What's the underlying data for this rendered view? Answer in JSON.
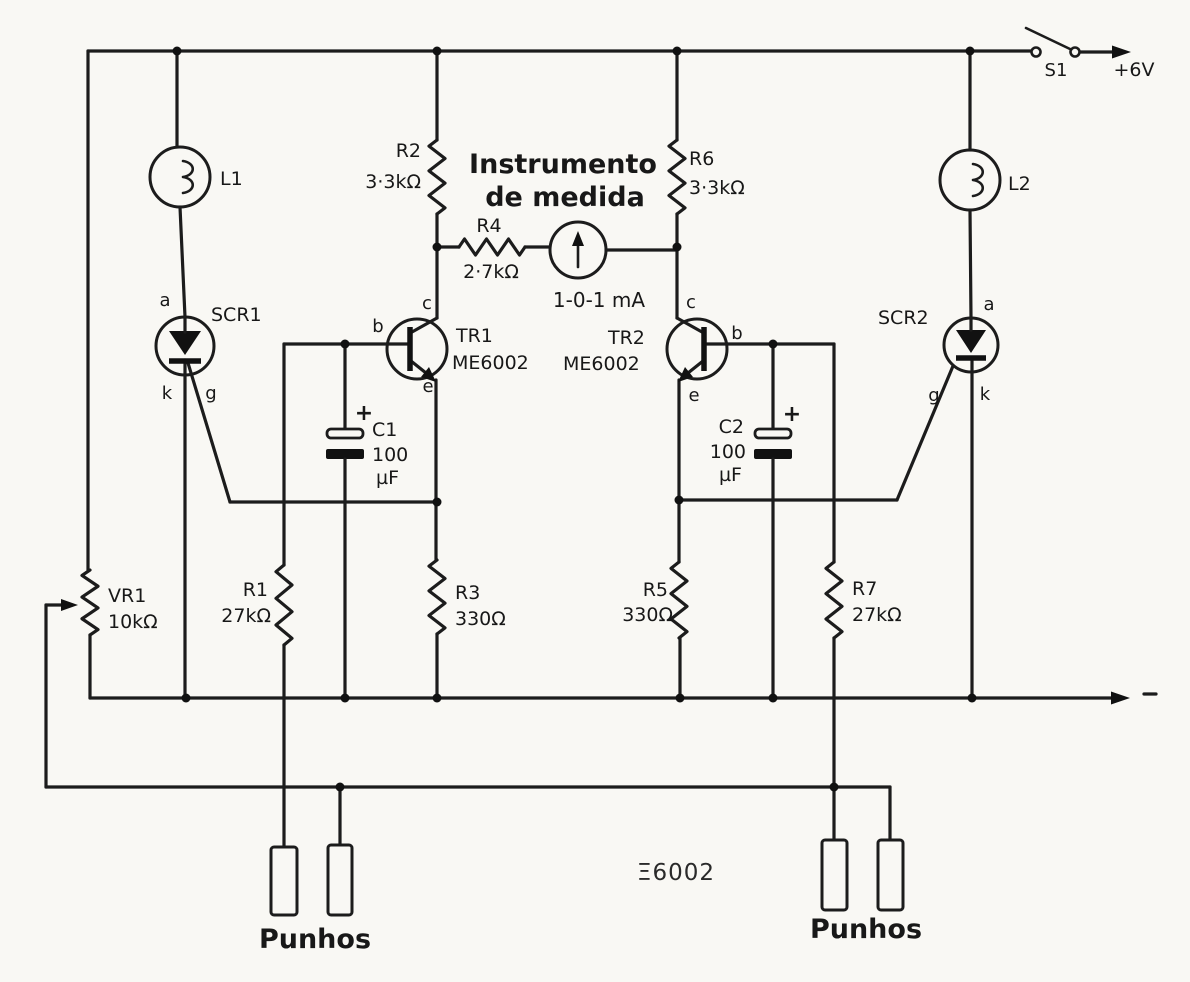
{
  "power": {
    "switch_label": "S1",
    "supply_label": "+6V"
  },
  "lamps": {
    "l1": "L1",
    "l2": "L2"
  },
  "scrs": {
    "scr1": {
      "name": "SCR1",
      "anode": "a",
      "cathode": "k",
      "gate": "g"
    },
    "scr2": {
      "name": "SCR2",
      "anode": "a",
      "cathode": "k",
      "gate": "g"
    }
  },
  "transistors": {
    "tr1": {
      "name": "TR1",
      "part": "ME6002",
      "collector": "c",
      "base": "b",
      "emitter": "e"
    },
    "tr2": {
      "name": "TR2",
      "part": "ME6002",
      "collector": "c",
      "base": "b",
      "emitter": "e"
    }
  },
  "resistors": {
    "r1": {
      "name": "R1",
      "value": "27kΩ"
    },
    "r2": {
      "name": "R2",
      "value": "3·3kΩ"
    },
    "r3": {
      "name": "R3",
      "value": "330Ω"
    },
    "r4": {
      "name": "R4",
      "value": "2·7kΩ"
    },
    "r5": {
      "name": "R5",
      "value": "330Ω"
    },
    "r6": {
      "name": "R6",
      "value": "3·3kΩ"
    },
    "r7": {
      "name": "R7",
      "value": "27kΩ"
    },
    "vr1": {
      "name": "VR1",
      "value": "10kΩ"
    }
  },
  "capacitors": {
    "c1": {
      "name": "C1",
      "value": "100",
      "unit": "µF",
      "polarity": "+"
    },
    "c2": {
      "name": "C2",
      "value": "100",
      "unit": "µF",
      "polarity": "+"
    }
  },
  "meter": {
    "caption_line1": "Instrumento",
    "caption_line2": "de medida",
    "range": "1-0-1 mA"
  },
  "electrodes": {
    "left_label": "Punhos",
    "right_label": "Punhos"
  },
  "annotations": {
    "stray_text": "Ξ6002"
  }
}
